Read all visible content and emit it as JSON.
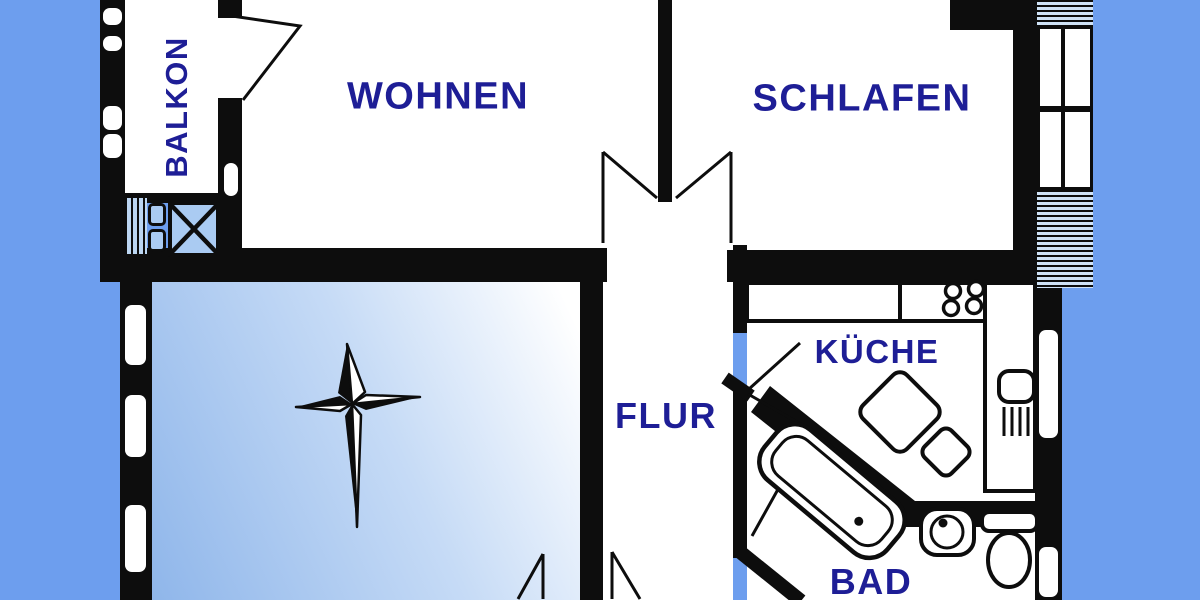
{
  "scene": {
    "type": "apartment-floor-plan"
  },
  "colors": {
    "background": "#6d9eee",
    "wall": "#0d0d0d",
    "label_text": "#1e1e96",
    "glass_fill": "#aacbf2",
    "room_fill": "#ffffff"
  },
  "rooms": {
    "balkon": {
      "label": "BALKON"
    },
    "wohnen": {
      "label": "WOHNEN"
    },
    "schlafen": {
      "label": "SCHLAFEN"
    },
    "flur": {
      "label": "FLUR"
    },
    "kueche": {
      "label": "KÜCHE"
    },
    "bad": {
      "label": "BAD"
    }
  },
  "fixtures": [
    "north-arrow-compass",
    "bathtub",
    "washbasin",
    "toilet",
    "kitchen-sink",
    "stove-burners",
    "radiator",
    "balcony-railing",
    "window",
    "door-swing",
    "shaft-cross-box"
  ]
}
